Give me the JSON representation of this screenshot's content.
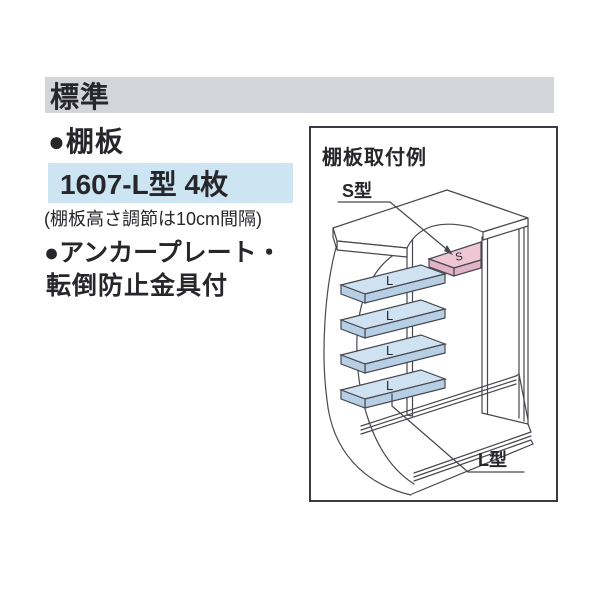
{
  "header": {
    "title": "標準"
  },
  "specs": {
    "shelf_heading": "●棚板",
    "shelf_model": "1607-L型 4枚",
    "shelf_note": "(棚板高さ調節は10cm間隔)",
    "anchor_line1": "●アンカープレート・",
    "anchor_line2": "転倒防止金具付"
  },
  "diagram": {
    "title": "棚板取付例",
    "s_type_label": "S型",
    "l_type_label": "L型",
    "s_shelf_label": "S",
    "l_shelf_labels": [
      "L",
      "L",
      "L",
      "L"
    ]
  },
  "colors": {
    "header_bg": "#d4d5da",
    "model_highlight_bg": "#cde4f2",
    "shelf_blue_top": "#cfe2f1",
    "shelf_blue_side": "#b7cfe5",
    "shelf_pink_top": "#eec6d4",
    "shelf_pink_side": "#e2b3c7",
    "line_color": "#47474f",
    "text_color": "#27272b"
  }
}
